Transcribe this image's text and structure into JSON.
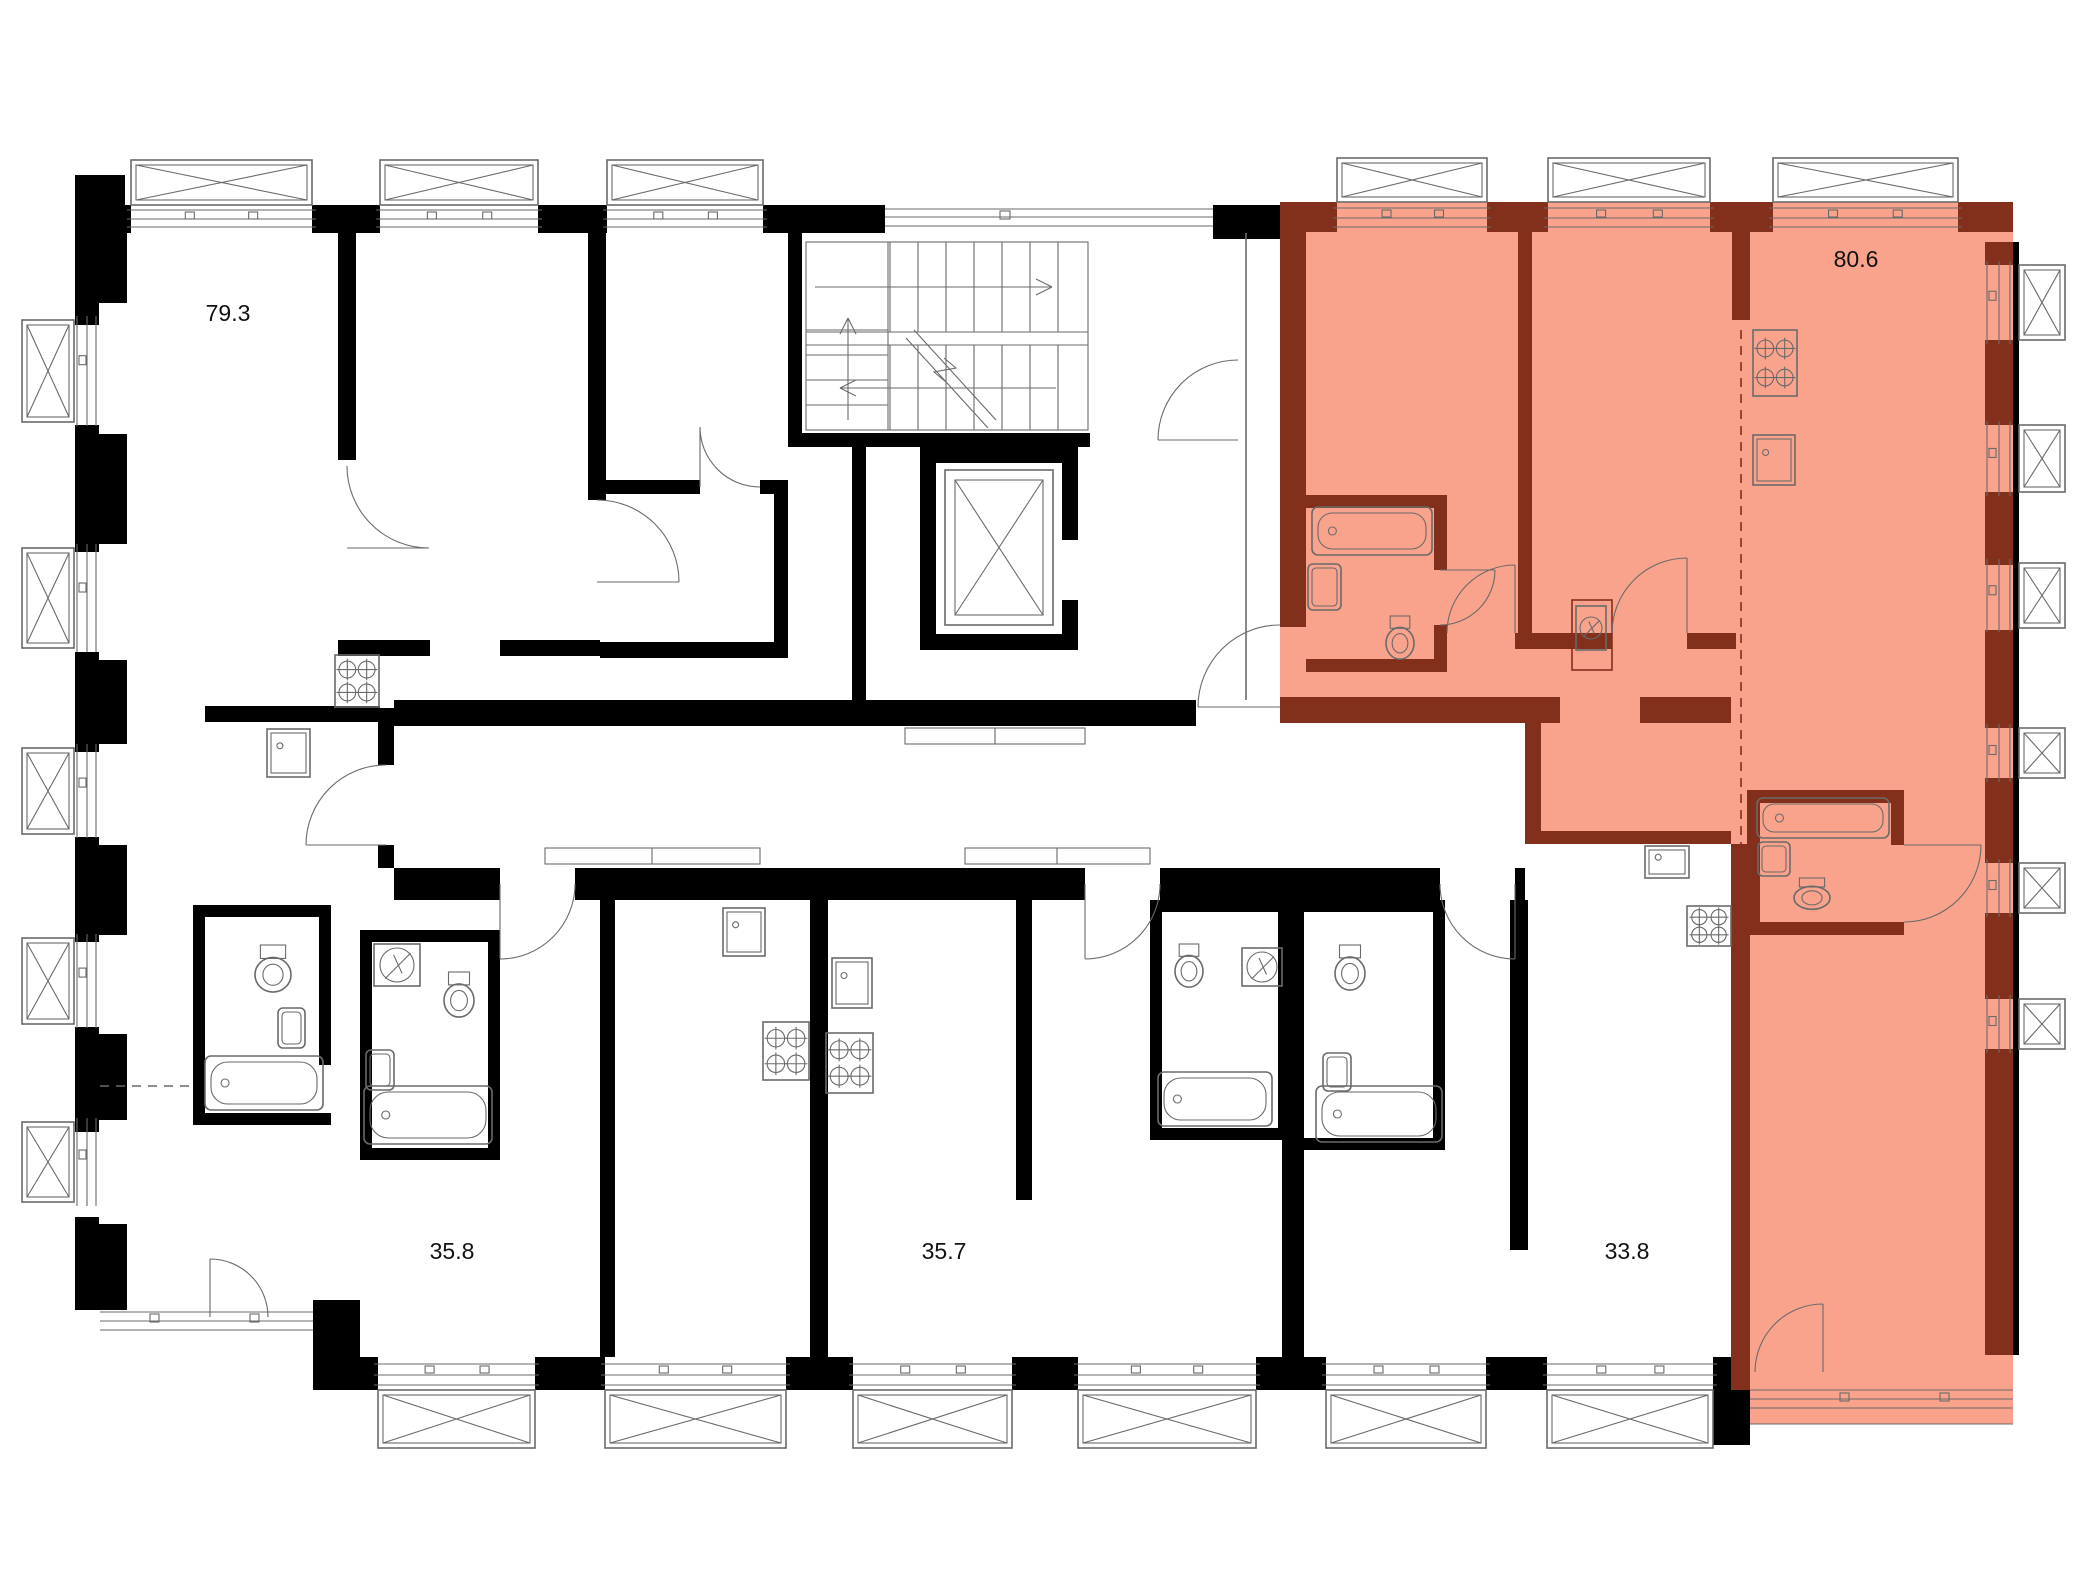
{
  "page": {
    "type": "residential-floor-plan"
  },
  "apartments": [
    {
      "name": "apt-79-3",
      "area_label": "79.3",
      "highlighted": false
    },
    {
      "name": "apt-80-6",
      "area_label": "80.6",
      "highlighted": true
    },
    {
      "name": "apt-35-8",
      "area_label": "35.8",
      "highlighted": false
    },
    {
      "name": "apt-35-7",
      "area_label": "35.7",
      "highlighted": false
    },
    {
      "name": "apt-33-8",
      "area_label": "33.8",
      "highlighted": false
    }
  ],
  "colors": {
    "wall": "#000000",
    "highlight_wall": "#82301B",
    "highlight_fill": "#F9A38C",
    "line": "#6A6A6A",
    "background": "#FFFFFF",
    "text": "#111111"
  },
  "icons": [
    "window-icon",
    "door-icon",
    "stairs-icon",
    "elevator-icon",
    "bathtub-icon",
    "toilet-icon",
    "sink-icon",
    "stove-icon",
    "electrical-panel-icon"
  ]
}
